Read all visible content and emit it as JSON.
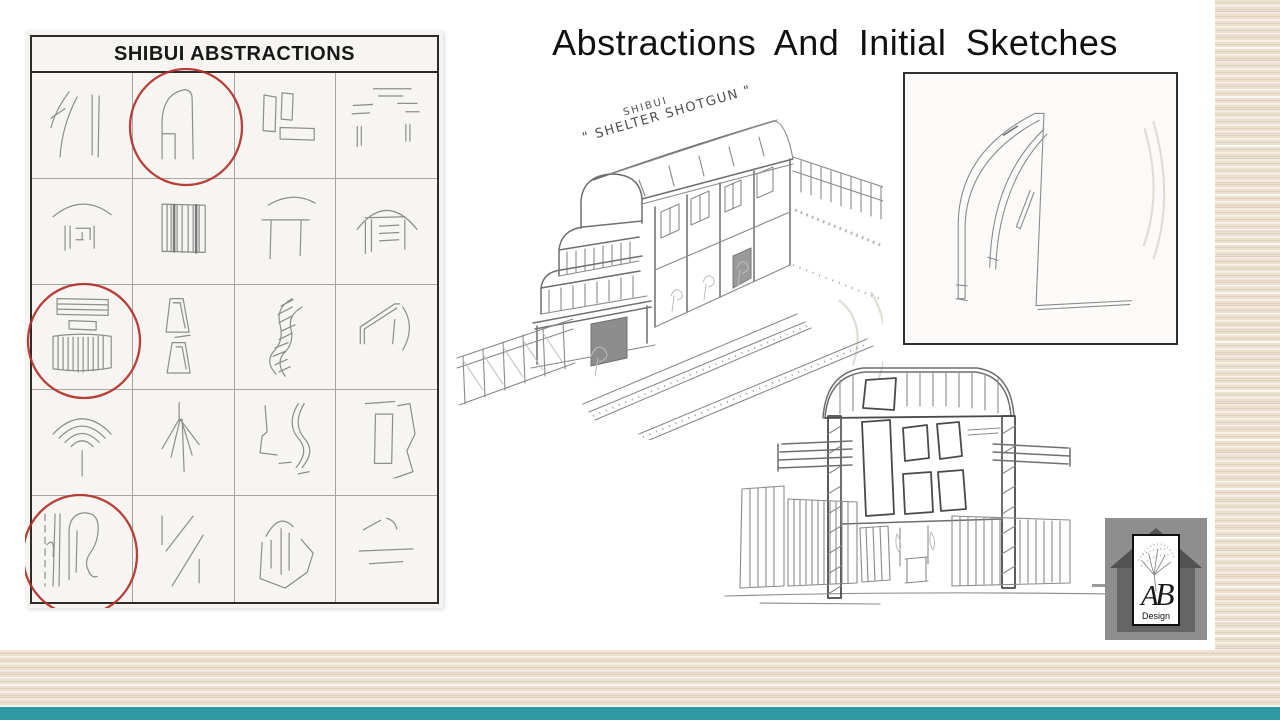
{
  "slide": {
    "title": "Abstractions And Initial Sketches"
  },
  "abstraction_chart": {
    "title": "SHIBUI ABSTRACTIONS",
    "rows": 5,
    "columns": 4,
    "circled_cells": [
      "row1-col2",
      "row3-col1",
      "row5-col1"
    ],
    "cells": [
      "curved-arcs-and-posts",
      "arched-doorway",
      "stacked-rectangles",
      "horizontal-dashes",
      "arc-over-posts",
      "striped-panel",
      "arc-over-table-frame",
      "arched-shelter-facade",
      "lined-bars-over-striped-screen",
      "stacked-trapezoids",
      "twisted-helix-band",
      "bent-beam-and-arc",
      "fanned-arcs-over-stem",
      "radiating-branches",
      "winding-path",
      "panel-and-angular-outline",
      "loop-with-posts-and-dashed-line",
      "diagonal-strokes",
      "arch-in-angular-enclosure",
      "dashed-trapezoid"
    ],
    "annotation_color": "#b23029"
  },
  "shelter_sketch": {
    "caption_line1": "SHIBUI",
    "caption_line2": "\" SHELTER SHOTGUN \""
  },
  "logo": {
    "initial_a": "A",
    "initial_b": "B",
    "caption": "Design"
  },
  "colors": {
    "accent_bar": "#2e99a3",
    "paper_texture": "#ece1cf",
    "pencil": "#8e8e8e"
  }
}
